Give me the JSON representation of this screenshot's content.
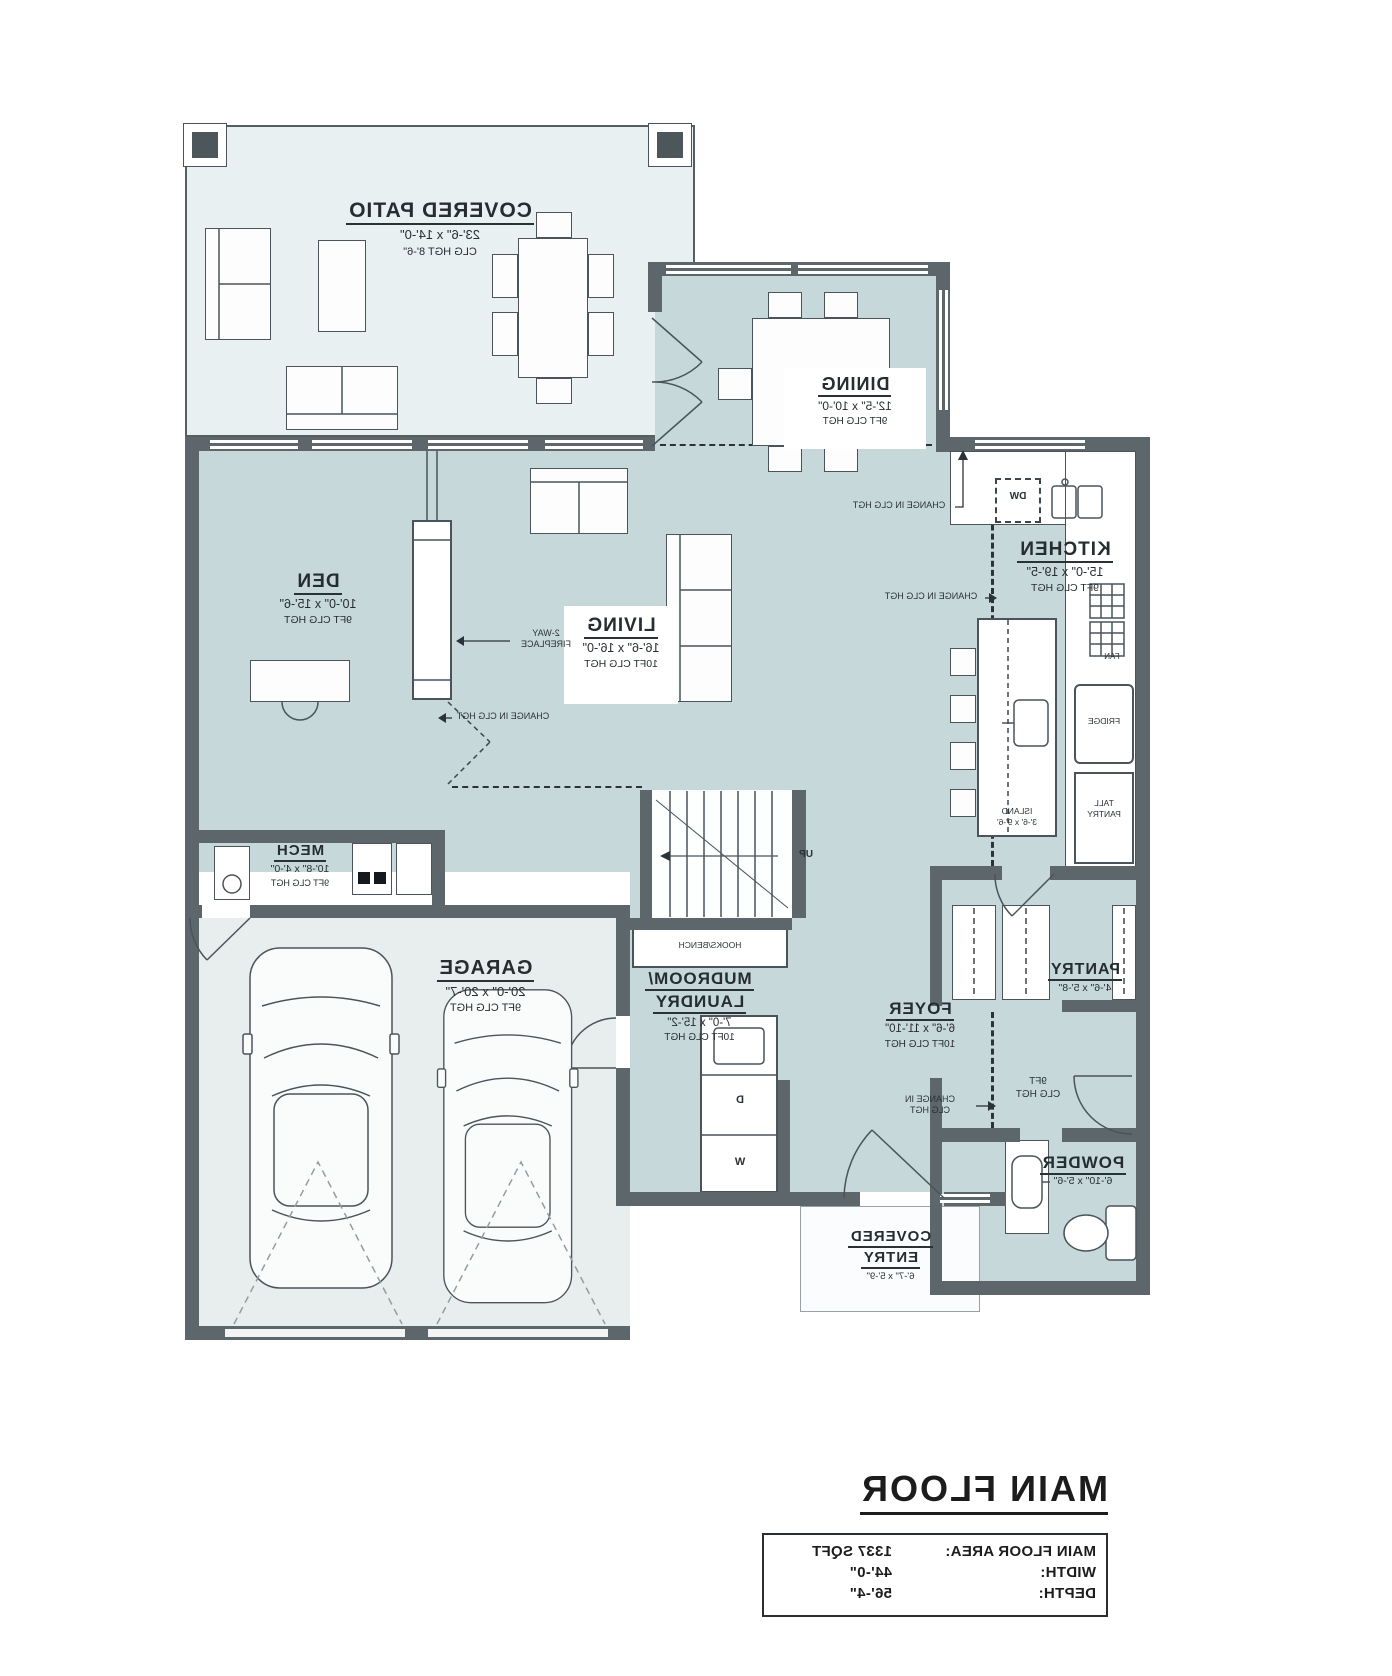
{
  "plan": {
    "rooms": {
      "covered_patio": {
        "name": "COVERED PATIO",
        "dims": "23'-6\" x 14'-0\"",
        "ceiling": "CLG HGT 8'-6\""
      },
      "dining": {
        "name": "DINING",
        "dims": "12'-5\" x 10'-0\"",
        "ceiling": "9FT CLG HGT"
      },
      "den": {
        "name": "DEN",
        "dims": "10'-0\" x 15'-6\"",
        "ceiling": "9FT CLG HGT"
      },
      "living": {
        "name": "LIVING",
        "dims": "16'-6\" x 16'-0\"",
        "ceiling": "10FT CLG HGT"
      },
      "kitchen": {
        "name": "KITCHEN",
        "dims": "15'-0\" x 19'-5\"",
        "ceiling": "9FT CLG HGT"
      },
      "mech": {
        "name": "MECH",
        "dims": "10'-8\" x 4'-0\"",
        "ceiling": "9FT CLG HGT"
      },
      "garage": {
        "name": "GARAGE",
        "dims": "20'-0\" x 20'-7\"",
        "ceiling": "9FT CLG HGT"
      },
      "mudroom": {
        "name_line1": "MUDROOM/",
        "name_line2": "LAUNDRY",
        "dims": "7'-0\" x 15'-2\"",
        "ceiling": "10FT CLG HGT"
      },
      "foyer": {
        "name": "FOYER",
        "dims": "6'-6\" x 11'-10\"",
        "ceiling": "10FT CLG HGT"
      },
      "pantry": {
        "name": "PANTRY",
        "dims": "4'-6\" x 5'-8\""
      },
      "powder": {
        "name": "POWDER",
        "dims": "6'-10\" x 5'-6\""
      },
      "covered_entry": {
        "name_line1": "COVERED",
        "name_line2": "ENTRY",
        "dims": "6'-7\" x 5'-9\""
      },
      "hall": {
        "ceiling_line1": "9FT",
        "ceiling_line2": "CLG HGT"
      }
    },
    "fixtures": {
      "dw": "DW",
      "fan": "FAN",
      "fridge": "FRIDGE",
      "tall_pantry_line1": "TALL",
      "tall_pantry_line2": "PANTRY",
      "island_line1": "ISLAND",
      "island_line2": "3'-6' x 9'-6'",
      "hooks_bench": "HOOKS/BENCH",
      "up": "UP",
      "washer": "W",
      "dryer": "D",
      "fireplace_line1": "2-WAY",
      "fireplace_line2": "FIREPLACE"
    },
    "annotations": {
      "change_clg": "CHANGE IN CLG HGT",
      "change_clg_line1": "CHANGE IN",
      "change_clg_line2": "CLG HGT"
    }
  },
  "title_block": {
    "title": "MAIN FLOOR",
    "rows": [
      {
        "label": "MAIN FLOOR AREA:",
        "value": "1337 SQFT"
      },
      {
        "label": "WIDTH:",
        "value": "44'-0\""
      },
      {
        "label": "DEPTH:",
        "value": "56'-4\""
      }
    ]
  },
  "colors": {
    "wall": "#5c666b",
    "room_fill": "#c6d8da",
    "patio_fill": "#e9f0f2",
    "garage_fill": "#e8edee",
    "text": "#262d31"
  }
}
